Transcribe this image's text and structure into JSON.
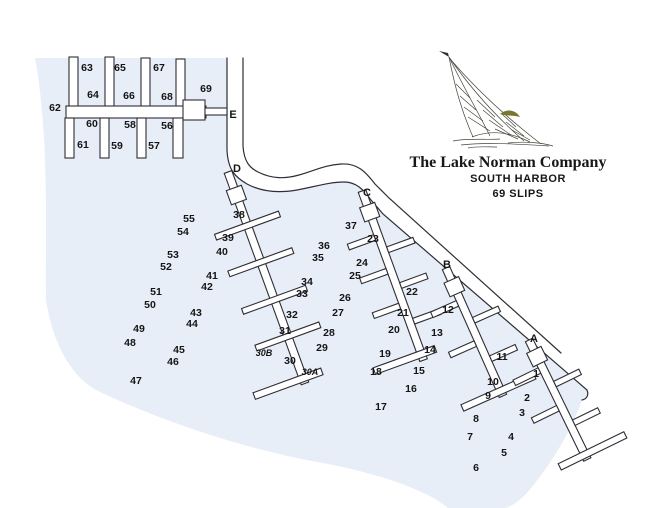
{
  "title": {
    "company": "The Lake Norman Company",
    "subtitle": "SOUTH HARBOR",
    "slips": "69 SLIPS"
  },
  "map": {
    "colors": {
      "water": "#e8eef7",
      "outline": "#2e2e36",
      "label": "#151515",
      "dock_fill": "#ffffff",
      "accent_olive": "#77772f"
    },
    "water_path": "M35,58 L227,58 L227,150 C228,170 235,177 247,184 C262,192 280,193 297,190 C314,187 329,182 344,182 C356,182 363,189 371,200 L383,214 L587,390 C589,395 587,399 582,400 C574,424 557,456 532,487 C524,497 516,504 506,508 L448,508 C430,492 380,473 317,462 C240,448 160,420 100,392 C70,378 52,340 46,300 C45,240 50,140 35,58 Z",
    "road_upper": "M243,58 L243,146 C244,162 250,168 258,172 C272,179 285,179 299,175 C314,171 324,165 341,164 C357,163 365,171 375,184 L389,198 L561,353",
    "road_lower": "M227,58 L227,150 C228,170 235,177 247,184 C262,192 280,193 297,190 C314,187 329,182 344,182 C356,182 363,189 371,200 L383,214 L587,390 C589,395 587,399 582,400",
    "docks": [
      {
        "id": "E",
        "origin": [
          0,
          0
        ],
        "angle": 0,
        "rects": [
          [
            69,
            57,
            9,
            51
          ],
          [
            105,
            57,
            9,
            51
          ],
          [
            141,
            58,
            9,
            50
          ],
          [
            176,
            59,
            9,
            49
          ],
          [
            66,
            106,
            140,
            12
          ],
          [
            183,
            100,
            22,
            20
          ],
          [
            205,
            108,
            22,
            7
          ],
          [
            65,
            118,
            9,
            40
          ],
          [
            100,
            118,
            9,
            40
          ],
          [
            137,
            118,
            9,
            40
          ],
          [
            173,
            118,
            10,
            40
          ]
        ]
      },
      {
        "id": "D",
        "origin": [
          228,
          172
        ],
        "angle": -20,
        "rects": [
          [
            -4,
            0,
            8,
            225
          ],
          [
            -8,
            17,
            16,
            15
          ],
          [
            -34,
            54,
            68,
            6
          ],
          [
            -34,
            93,
            68,
            6
          ],
          [
            -34,
            133,
            68,
            6
          ],
          [
            -34,
            172,
            68,
            6
          ],
          [
            -52,
            216,
            72,
            7
          ]
        ]
      },
      {
        "id": "C",
        "origin": [
          362,
          191
        ],
        "angle": -20,
        "rects": [
          [
            -4,
            0,
            8,
            180
          ],
          [
            -8,
            15,
            16,
            15
          ],
          [
            -32,
            45,
            28,
            6
          ],
          [
            -32,
            81,
            28,
            6
          ],
          [
            -32,
            118,
            28,
            6
          ],
          [
            4,
            61,
            28,
            6
          ],
          [
            4,
            99,
            28,
            6
          ],
          [
            4,
            137,
            28,
            6
          ],
          [
            -50,
            170,
            65,
            7
          ]
        ]
      },
      {
        "id": "B",
        "origin": [
          446,
          268
        ],
        "angle": -24,
        "rects": [
          [
            -4,
            0,
            8,
            140
          ],
          [
            -8,
            13,
            16,
            15
          ],
          [
            -32,
            34,
            28,
            6
          ],
          [
            -32,
            78,
            28,
            6
          ],
          [
            4,
            56,
            28,
            6
          ],
          [
            4,
            98,
            28,
            6
          ],
          [
            -42,
            131,
            79,
            7
          ]
        ]
      },
      {
        "id": "A",
        "origin": [
          529,
          340
        ],
        "angle": -26,
        "rects": [
          [
            -4,
            0,
            8,
            133
          ],
          [
            -8,
            11,
            16,
            15
          ],
          [
            -32,
            29,
            28,
            6
          ],
          [
            -32,
            71,
            28,
            6
          ],
          [
            4,
            48,
            28,
            6
          ],
          [
            4,
            91,
            28,
            6
          ],
          [
            -28,
            124,
            73,
            7
          ]
        ]
      }
    ],
    "dock_letters": [
      {
        "t": "E",
        "x": 233,
        "y": 118
      },
      {
        "t": "D",
        "x": 237,
        "y": 172
      },
      {
        "t": "C",
        "x": 367,
        "y": 196
      },
      {
        "t": "B",
        "x": 447,
        "y": 268
      },
      {
        "t": "A",
        "x": 534,
        "y": 342
      }
    ],
    "slip_labels": [
      {
        "t": "62",
        "x": 55,
        "y": 111
      },
      {
        "t": "63",
        "x": 87,
        "y": 71
      },
      {
        "t": "64",
        "x": 93,
        "y": 98
      },
      {
        "t": "65",
        "x": 120,
        "y": 71
      },
      {
        "t": "66",
        "x": 129,
        "y": 99
      },
      {
        "t": "67",
        "x": 159,
        "y": 71
      },
      {
        "t": "68",
        "x": 167,
        "y": 100
      },
      {
        "t": "69",
        "x": 206,
        "y": 92
      },
      {
        "t": "60",
        "x": 92,
        "y": 127
      },
      {
        "t": "61",
        "x": 83,
        "y": 148
      },
      {
        "t": "58",
        "x": 130,
        "y": 128
      },
      {
        "t": "59",
        "x": 117,
        "y": 149
      },
      {
        "t": "56",
        "x": 167,
        "y": 129
      },
      {
        "t": "57",
        "x": 154,
        "y": 149
      },
      {
        "t": "55",
        "x": 189,
        "y": 222
      },
      {
        "t": "54",
        "x": 183,
        "y": 235
      },
      {
        "t": "53",
        "x": 173,
        "y": 258
      },
      {
        "t": "52",
        "x": 166,
        "y": 270
      },
      {
        "t": "51",
        "x": 156,
        "y": 295
      },
      {
        "t": "50",
        "x": 150,
        "y": 308
      },
      {
        "t": "49",
        "x": 139,
        "y": 332
      },
      {
        "t": "48",
        "x": 130,
        "y": 346
      },
      {
        "t": "47",
        "x": 136,
        "y": 384
      },
      {
        "t": "38",
        "x": 239,
        "y": 218
      },
      {
        "t": "39",
        "x": 228,
        "y": 241
      },
      {
        "t": "40",
        "x": 222,
        "y": 255
      },
      {
        "t": "41",
        "x": 212,
        "y": 279
      },
      {
        "t": "42",
        "x": 207,
        "y": 290
      },
      {
        "t": "43",
        "x": 196,
        "y": 316
      },
      {
        "t": "44",
        "x": 192,
        "y": 327
      },
      {
        "t": "45",
        "x": 179,
        "y": 353
      },
      {
        "t": "46",
        "x": 173,
        "y": 365
      },
      {
        "t": "37",
        "x": 351,
        "y": 229
      },
      {
        "t": "36",
        "x": 324,
        "y": 249
      },
      {
        "t": "35",
        "x": 318,
        "y": 261
      },
      {
        "t": "34",
        "x": 307,
        "y": 285
      },
      {
        "t": "33",
        "x": 302,
        "y": 297
      },
      {
        "t": "32",
        "x": 292,
        "y": 318
      },
      {
        "t": "31",
        "x": 285,
        "y": 334
      },
      {
        "t": "23",
        "x": 373,
        "y": 242
      },
      {
        "t": "24",
        "x": 362,
        "y": 266
      },
      {
        "t": "25",
        "x": 355,
        "y": 279
      },
      {
        "t": "26",
        "x": 345,
        "y": 301
      },
      {
        "t": "27",
        "x": 338,
        "y": 316
      },
      {
        "t": "28",
        "x": 329,
        "y": 336
      },
      {
        "t": "29",
        "x": 322,
        "y": 351
      },
      {
        "t": "30B",
        "x": 264,
        "y": 356,
        "it": true
      },
      {
        "t": "30",
        "x": 290,
        "y": 364
      },
      {
        "t": "30A",
        "x": 310,
        "y": 375,
        "it": true
      },
      {
        "t": "22",
        "x": 412,
        "y": 295
      },
      {
        "t": "21",
        "x": 403,
        "y": 316
      },
      {
        "t": "20",
        "x": 394,
        "y": 333
      },
      {
        "t": "19",
        "x": 385,
        "y": 357
      },
      {
        "t": "18",
        "x": 376,
        "y": 375
      },
      {
        "t": "17",
        "x": 381,
        "y": 410
      },
      {
        "t": "12",
        "x": 448,
        "y": 313
      },
      {
        "t": "13",
        "x": 437,
        "y": 336
      },
      {
        "t": "14",
        "x": 430,
        "y": 353
      },
      {
        "t": "15",
        "x": 419,
        "y": 374
      },
      {
        "t": "16",
        "x": 411,
        "y": 392
      },
      {
        "t": "11",
        "x": 502,
        "y": 360
      },
      {
        "t": "10",
        "x": 493,
        "y": 385
      },
      {
        "t": "9",
        "x": 488,
        "y": 399
      },
      {
        "t": "8",
        "x": 476,
        "y": 422
      },
      {
        "t": "7",
        "x": 470,
        "y": 440
      },
      {
        "t": "6",
        "x": 476,
        "y": 471
      },
      {
        "t": "1",
        "x": 536,
        "y": 377
      },
      {
        "t": "2",
        "x": 527,
        "y": 401
      },
      {
        "t": "3",
        "x": 522,
        "y": 416
      },
      {
        "t": "4",
        "x": 511,
        "y": 440
      },
      {
        "t": "5",
        "x": 504,
        "y": 456
      }
    ]
  }
}
